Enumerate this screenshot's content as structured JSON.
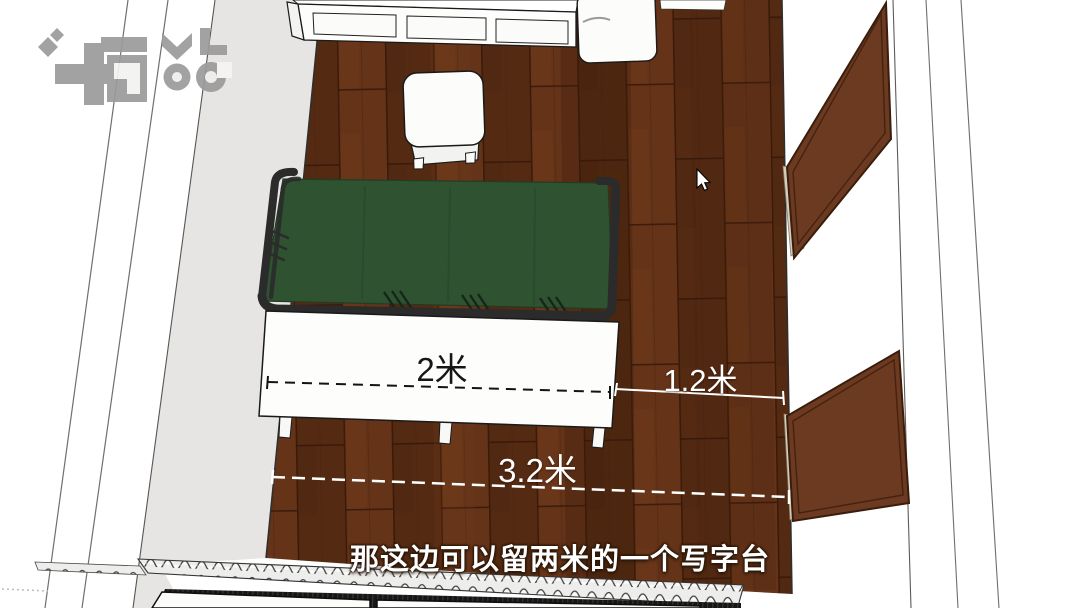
{
  "view": {
    "description": "top-down 3d room view"
  },
  "watermark": {
    "icon": "brand-logo-watermark",
    "color": "#9b9b9b"
  },
  "labels": {
    "bed_length": "2米",
    "side_gap": "1.2米",
    "total_width": "3.2米"
  },
  "subtitle": {
    "text": "那这边可以留两米的一个写字台",
    "color": "#ffffff"
  },
  "cursor": {
    "icon": "arrow-cursor"
  },
  "colors": {
    "floor_wood": "#5d2f16",
    "wall_gray": "#e6e5e3",
    "sofa_green": "#2f5330",
    "frame_black": "#2b2b2b",
    "door_brown": "#6b3a20",
    "door_trim_tan": "#d6ccba",
    "furniture_white": "#fcfcfb",
    "dimension_dark": "#141414",
    "dimension_light": "#ffffff"
  },
  "objects": [
    {
      "name": "wall-shelf-unit"
    },
    {
      "name": "white-cabinet-box"
    },
    {
      "name": "stool"
    },
    {
      "name": "green-sofa-bed"
    },
    {
      "name": "white-bed-panel"
    },
    {
      "name": "door-panel-upper"
    },
    {
      "name": "door-panel-lower"
    },
    {
      "name": "radiator"
    },
    {
      "name": "window-sill"
    },
    {
      "name": "wood-floor"
    }
  ]
}
